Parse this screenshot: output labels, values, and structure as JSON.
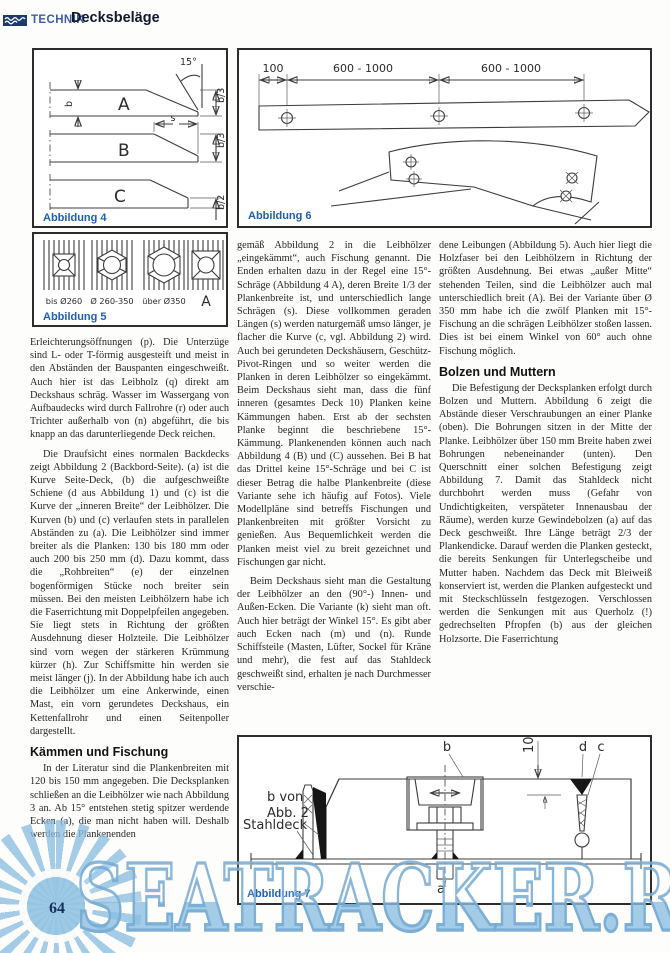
{
  "header": {
    "section": "TECHNIK",
    "title": "Decksbeläge"
  },
  "figures": {
    "fig4": {
      "caption": "Abbildung 4",
      "labels": {
        "angle": "15°",
        "plank_a": "A",
        "plank_b": "B",
        "plank_c": "C",
        "dim_b": "b",
        "dim_s": "s",
        "b3_top": "b/3",
        "b3_mid": "b/3",
        "b2": "b/2"
      }
    },
    "fig5": {
      "caption": "Abbildung 5",
      "labels": {
        "l1": "bis Ø260",
        "l2": "Ø 260-350",
        "l3": "über Ø350",
        "l4": "A"
      }
    },
    "fig6": {
      "caption": "Abbildung 6",
      "dims": {
        "d1": "100",
        "d2": "600 - 1000",
        "d3": "600 - 1000"
      }
    },
    "fig7": {
      "caption": "Abbildung 7",
      "labels": {
        "b": "b",
        "ten": "10",
        "d": "d",
        "c": "c",
        "b_von_1": "b von",
        "b_von_2": "Abb. 2",
        "stahldeck": "Stahldeck",
        "a": "a"
      }
    }
  },
  "columns": {
    "left": {
      "p1": "Erleichterungsöffnungen (p). Die Unterzüge sind L- oder T-förmig ausgesteift und meist in den Abständen der Bauspanten eingeschweißt. Auch hier ist das Leibholz (q) direkt am Deckshaus schräg. Wasser im Wassergang von Aufbaudecks wird durch Fallrohre (r) oder auch Trichter außerhalb von (n) abgeführt, die bis knapp an das darunterliegende Deck reichen.",
      "p2": "Die Draufsicht eines normalen Backdecks zeigt Abbildung 2 (Backbord-Seite). (a) ist die Kurve Seite-Deck, (b) die aufgeschweißte Schiene (d aus Abbildung 1) und (c) ist die Kurve der „inneren Breite“ der Leibhölzer. Die Kurven (b) und (c) verlaufen stets in parallelen Abständen zu (a). Die Leibhölzer sind immer breiter als die Planken: 130 bis 180 mm oder auch 200 bis 250 mm (d). Dazu kommt, dass die „Rohbreiten“ (e) der einzelnen bogenförmigen Stücke noch breiter sein müssen. Bei den meisten Leibhölzern habe ich die Faserrichtung mit Doppelpfeilen angegeben. Sie liegt stets in Richtung der größten Ausdehnung dieser Holzteile. Die Leibhölzer sind vorn wegen der stärkeren Krümmung kürzer (h). Zur Schiffsmitte hin werden sie meist länger (j). In der Abbildung habe ich auch die Leibhölzer um eine Ankerwinde, einen Mast, ein vorn gerundetes Deckshaus, ein Kettenfallrohr und einen Seitenpoller dargestellt.",
      "heading": "Kämmen und Fischung",
      "p3": "In der Literatur sind die Plankenbreiten mit 120 bis 150 mm angegeben. Die Decksplanken schließen an die Leibhölzer wie nach Abbildung 3 an. Ab 15° entstehen stetig spitzer werdende Ecken (a), die man nicht haben will. Deshalb werden die Plankenenden"
    },
    "middle": {
      "p1": "gemäß Abbildung 2 in die Leibhölzer „eingekämmt“, auch Fischung genannt. Die Enden erhalten dazu in der Regel eine 15°-Schräge (Abbildung 4 A), deren Breite 1/3 der Plankenbreite ist, und unterschiedlich lange Schrägen (s). Diese vollkommen geraden Längen (s) werden naturgemäß umso länger, je flacher die Kurve (c, vgl. Abbildung 2) wird. Auch bei gerundeten Deckshäusern, Geschütz-Pivot-Ringen und so weiter werden die Planken in deren Leibhölzer so eingekämmt. Beim Deckshaus sieht man, dass die fünf inneren (gesamtes Deck 10) Planken keine Kämmungen haben. Erst ab der sechsten Planke beginnt die beschriebene 15°-Kämmung. Plankenenden können auch nach Abbildung 4 (B) und (C) aussehen. Bei B hat das Drittel keine 15°-Schräge und bei C ist dieser Betrag die halbe Plankenbreite (diese Variante sehe ich häufig auf Fotos). Viele Modellpläne sind betreffs Fischungen und Plankenbreiten mit größter Vorsicht zu genießen. Aus Bequemlichkeit werden die Planken meist viel zu breit gezeichnet und Fischungen gar nicht.",
      "p2": "Beim Deckshaus sieht man die Gestaltung der Leibhölzer an den (90°-) Innen- und Außen-Ecken. Die Variante (k) sieht man oft. Auch hier beträgt der Winkel 15°. Es gibt aber auch Ecken nach (m) und (n). Runde Schiffsteile (Masten, Lüfter, Sockel für Kräne und mehr), die fest auf das Stahldeck geschweißt sind, erhalten je nach Durchmesser verschie-"
    },
    "right": {
      "p1": "dene Leibungen (Abbildung 5). Auch hier liegt die Holzfaser bei den Leibhölzern in Richtung der größten Ausdehnung. Bei etwas „außer Mitte“ stehenden Teilen, sind die Leibhölzer auch mal unterschiedlich breit (A). Bei der Variante über Ø 350 mm habe ich die zwölf Planken mit 15°-Fischung an die schrägen Leibhölzer stoßen lassen. Dies ist bei einem Winkel von 60° auch ohne Fischung möglich.",
      "heading": "Bolzen und Muttern",
      "p2": "Die Befestigung der Decksplanken erfolgt durch Bolzen und Muttern. Abbildung 6 zeigt die Abstände dieser Verschraubungen an einer Planke (oben). Die Bohrungen sitzen in der Mitte der Planke. Leibhölzer über 150 mm Breite haben zwei Bohrungen nebeneinander (unten). Den Querschnitt einer solchen Befestigung zeigt Abbildung 7. Damit das Stahldeck nicht durchbohrt werden muss (Gefahr von Undichtigkeiten, verspäteter Innenausbau der Räume), werden kurze Gewindebolzen (a) auf das Deck geschweißt. Ihre Länge beträgt 2/3 der Plankendicke. Darauf werden die Planken gesteckt, die bereits Senkungen für Unterlegscheibe und Mutter haben. Nachdem das Deck mit Bleiweiß konserviert ist, werden die Planken aufgesteckt und mit Steckschlüsseln festgezogen. Verschlossen werden die Senkungen mit aus Querholz (!) gedrechselten Pfropfen (b) aus der gleichen Holzsorte. Die Faserrichtung"
    }
  },
  "footer": {
    "page_number": "64"
  },
  "watermark": {
    "text": "SEATRACKER.RU"
  },
  "colors": {
    "accent_blue": "#1d5fb0",
    "header_navy": "#1c3a6e",
    "watermark_blue": "#8cbee0"
  }
}
